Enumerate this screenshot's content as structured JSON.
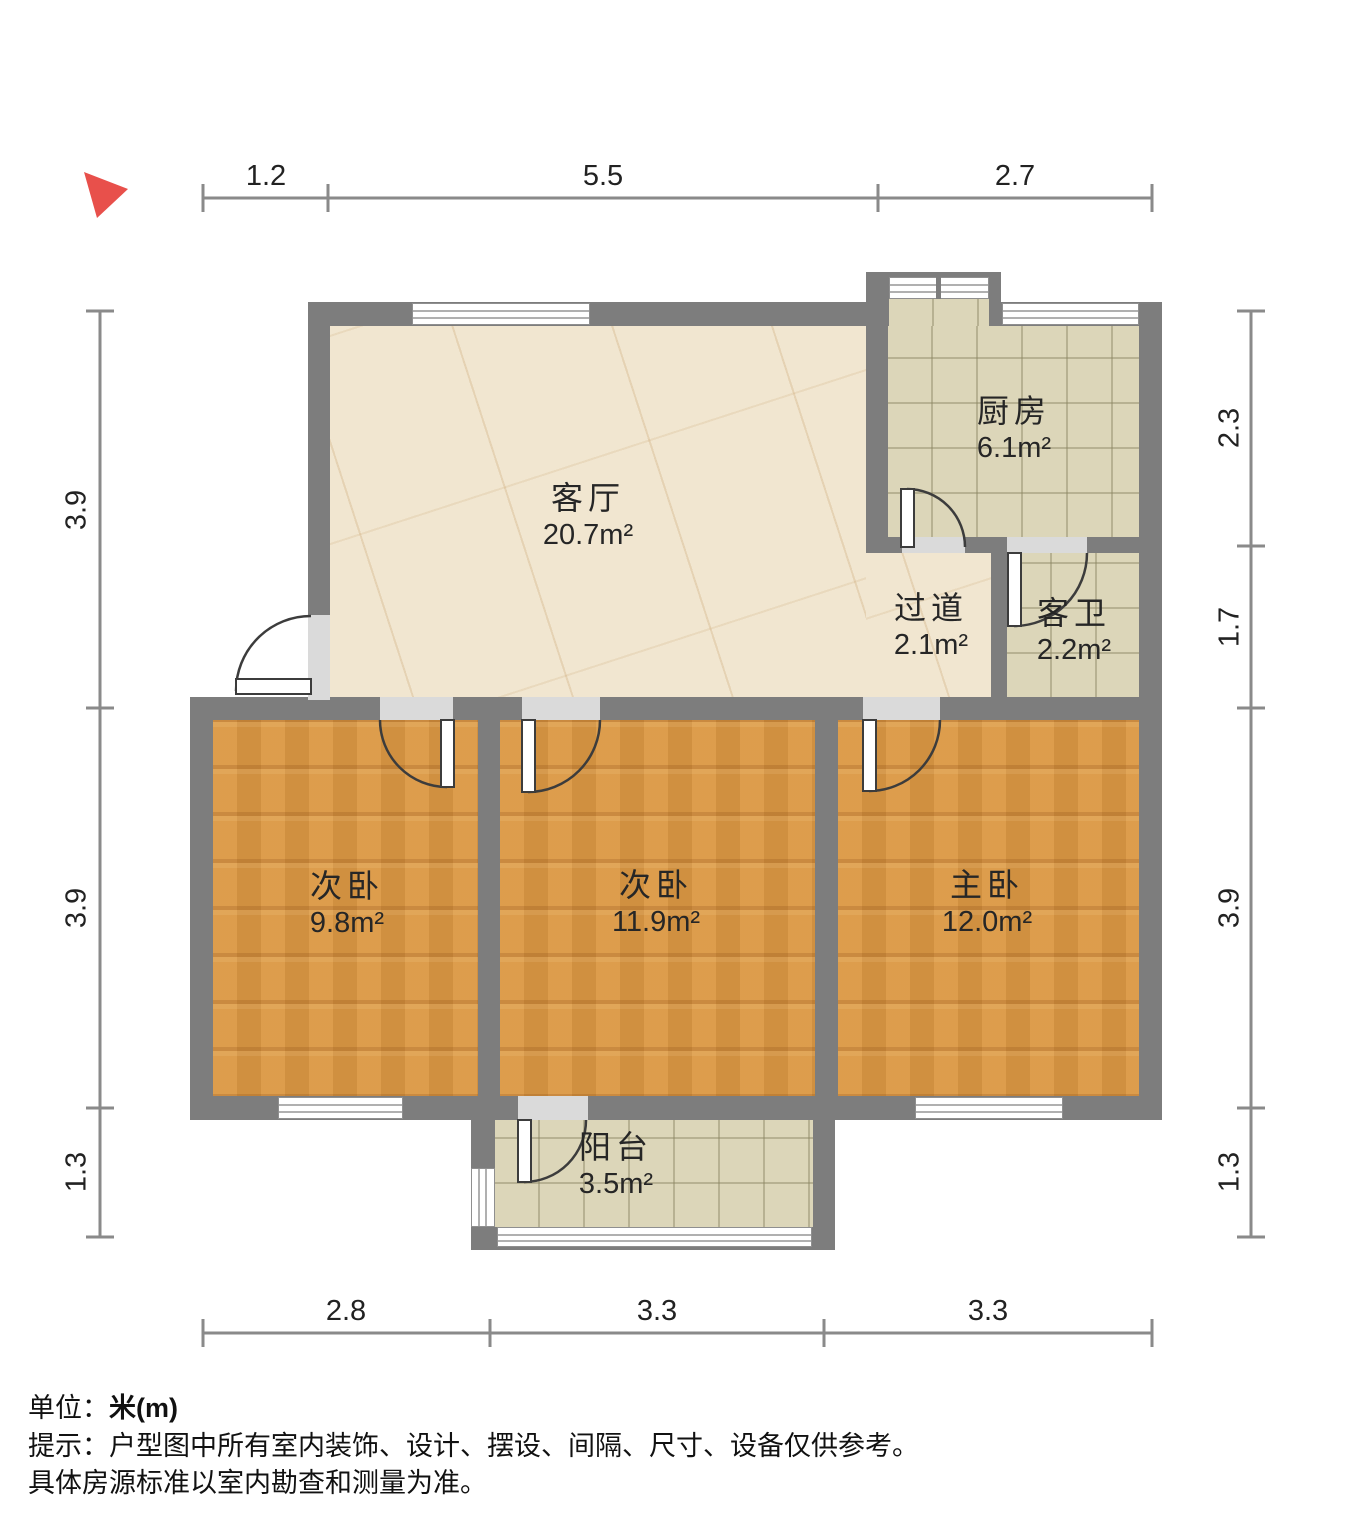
{
  "rooms": {
    "living": {
      "name": "客厅",
      "area": "20.7m²"
    },
    "kitchen": {
      "name": "厨房",
      "area": "6.1m²"
    },
    "hallway": {
      "name": "过道",
      "area": "2.1m²"
    },
    "bath": {
      "name": "客卫",
      "area": "2.2m²"
    },
    "bed1": {
      "name": "次卧",
      "area": "9.8m²"
    },
    "bed2": {
      "name": "次卧",
      "area": "11.9m²"
    },
    "master": {
      "name": "主卧",
      "area": "12.0m²"
    },
    "balcony": {
      "name": "阳台",
      "area": "3.5m²"
    }
  },
  "dimensions": {
    "top": [
      "1.2",
      "5.5",
      "2.7"
    ],
    "bottom": [
      "2.8",
      "3.3",
      "3.3"
    ],
    "left": [
      "3.9",
      "3.9",
      "1.3"
    ],
    "right": [
      "2.3",
      "1.7",
      "3.9",
      "1.3"
    ]
  },
  "footer": {
    "unit_label": "单位：",
    "unit_value": "米(m)",
    "tip_line1": "提示：户型图中所有室内装饰、设计、摆设、间隔、尺寸、设备仅供参考。",
    "tip_line2": "具体房源标准以室内勘查和测量为准。"
  },
  "colors": {
    "wall": "#7d7d7d",
    "wood_floor": "#db9843",
    "tile_floor": "#dcd6b9",
    "marble_floor": "#f1e6d0",
    "north_arrow": "#e8504b"
  }
}
